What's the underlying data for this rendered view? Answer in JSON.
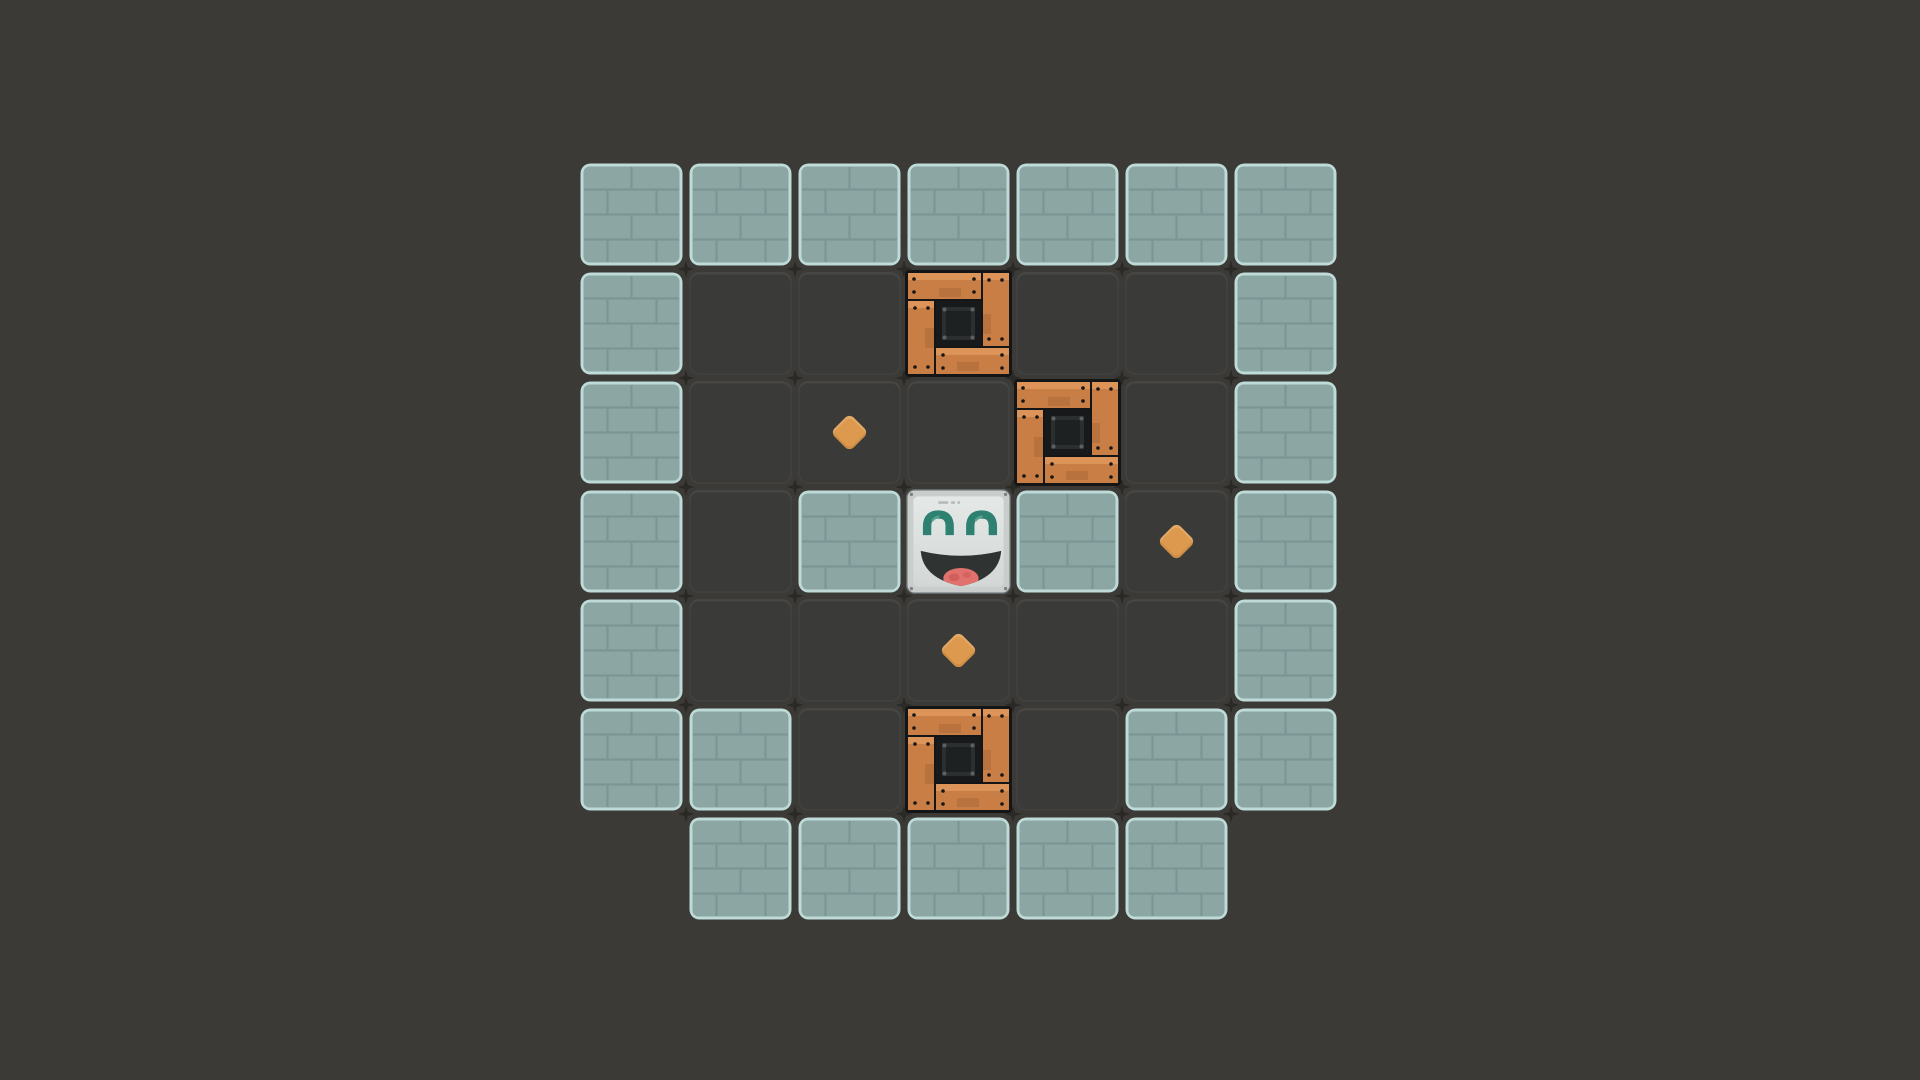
{
  "scene": {
    "description": "sokoban-style-puzzle-level",
    "background_color": "#3c3a36"
  },
  "board": {
    "rows": 7,
    "cols": 7,
    "tile_px": 109,
    "origin_px": {
      "x": 577,
      "y": 160
    },
    "legend": {
      "W": "wall",
      ".": "floor",
      "C": "crate",
      "G": "gem",
      "P": "player",
      "_": "empty"
    },
    "grid": [
      "WWWWWWW",
      "W..C..W",
      "W.G.C.W",
      "W.WPWGW",
      "W..G..W",
      "WW.C.WW",
      "_WWWWW_"
    ],
    "entity_counts": {
      "wall_tiles": 26,
      "floor_tiles": 14,
      "crates": 3,
      "gems": 3,
      "players": 1
    }
  },
  "palette": {
    "background": "#3c3a36",
    "wall_base": "#8ba6a3",
    "wall_mortar": "#7b9694",
    "wall_edge": "#bedbd8",
    "floor": "#3a3a38",
    "sparkle": "#2a2926",
    "crate_outline": "#141517",
    "crate_wood": "#c97e45",
    "crate_wood_light": "#dd9458",
    "crate_wood_dark": "#a96737",
    "crate_center": "#17191a",
    "crate_panel": "#2c2f30",
    "crate_panel_dark": "#1e2122",
    "crate_rivet": "#5c6062",
    "crate_nail": "#161616",
    "player_frame": "#c9cecc",
    "player_frame_line": "#62686a",
    "player_face_top": "#e4e9e7",
    "player_face_bottom": "#d3d8d6",
    "player_screw": "#7c827f",
    "player_vent": "#b5bbb8",
    "player_eye": "#2e8070",
    "player_eye_light": "#56a590",
    "player_mouth": "#2f3331",
    "player_tongue": "#e0716c",
    "player_tongue_dark": "#c4524f",
    "gem": "#dd9a4e"
  }
}
